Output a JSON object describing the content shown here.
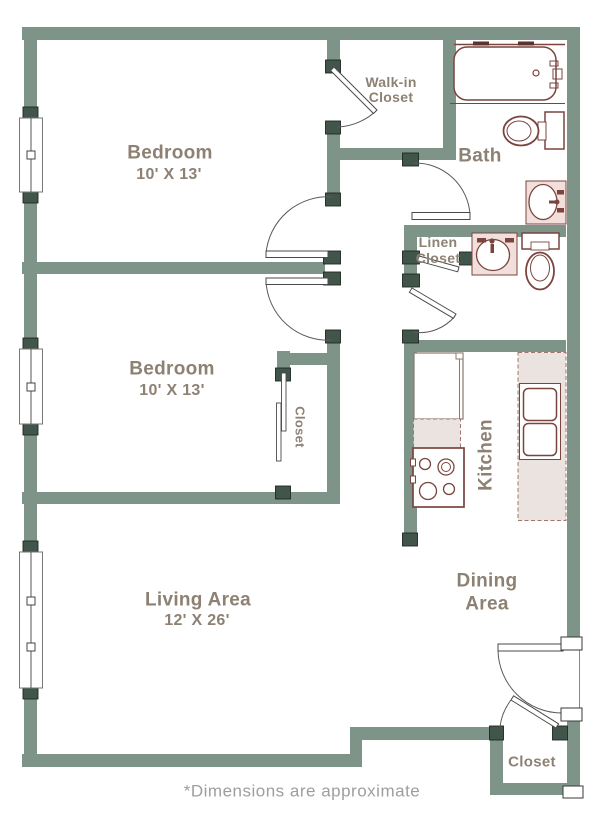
{
  "rooms": {
    "bedroom1": {
      "name": "Bedroom",
      "dims": "10' X 13'"
    },
    "bedroom2": {
      "name": "Bedroom",
      "dims": "10' X 13'"
    },
    "walk_in_closet": {
      "line1": "Walk-in",
      "line2": "Closet"
    },
    "bath": {
      "name": "Bath"
    },
    "linen_closet": {
      "line1": "Linen",
      "line2": "Closet"
    },
    "bedroom2_closet": {
      "name": "Closet"
    },
    "kitchen": {
      "name": "Kitchen"
    },
    "dining": {
      "line1": "Dining",
      "line2": "Area"
    },
    "living": {
      "name": "Living Area",
      "dims": "12' X 26'"
    },
    "entry_closet": {
      "name": "Closet"
    }
  },
  "footnote": "*Dimensions are approximate",
  "colors": {
    "wall": "#7E9489",
    "wall_post": "#42554B",
    "fixture_outline": "#7A453F",
    "fixture_dark": "#5D3330",
    "counter_fill": "#EAE3DF",
    "vanity_fill": "#F2DFDB",
    "label_text": "#8D8173",
    "footnote_text": "#9E9E9E"
  }
}
